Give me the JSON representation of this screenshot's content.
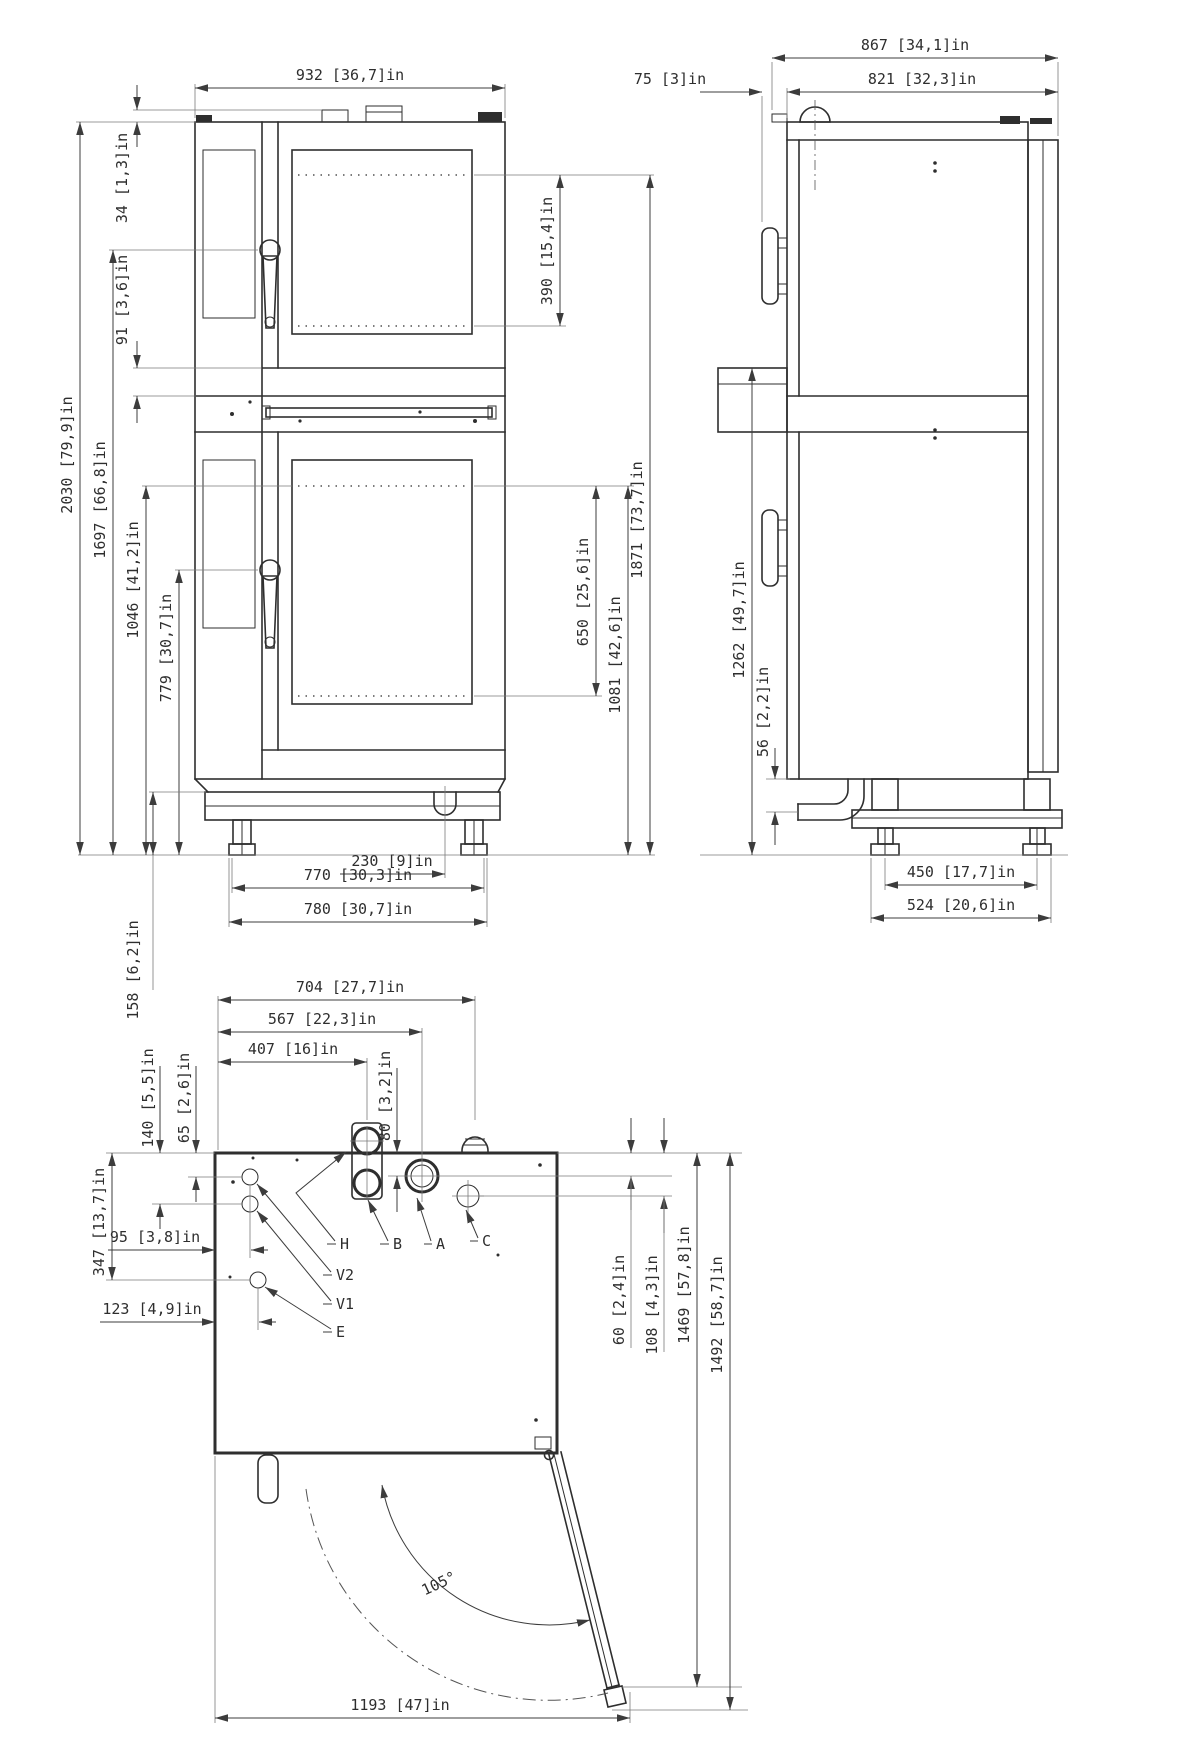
{
  "views": {
    "front": {
      "title": "front view",
      "dims": {
        "d932": "932 [36,7]in",
        "d34": "34 [1,3]in",
        "d91": "91 [3,6]in",
        "d2030": "2030 [79,9]in",
        "d1697": "1697 [66,8]in",
        "d1046": "1046 [41,2]in",
        "d779": "779 [30,7]in",
        "d158": "158 [6,2]in",
        "d390": "390 [15,4]in",
        "d650": "650 [25,6]in",
        "d1081": "1081 [42,6]in",
        "d1871": "1871 [73,7]in",
        "d230": "230 [9]in",
        "d770": "770 [30,3]in",
        "d780": "780 [30,7]in"
      }
    },
    "side": {
      "title": "side view",
      "dims": {
        "d867": "867 [34,1]in",
        "d821": "821 [32,3]in",
        "d75": "75 [3]in",
        "d1262": "1262 [49,7]in",
        "d56": "56 [2,2]in",
        "d450": "450 [17,7]in",
        "d524": "524 [20,6]in"
      }
    },
    "top": {
      "title": "top view",
      "dims": {
        "d704": "704 [27,7]in",
        "d567": "567 [22,3]in",
        "d407": "407 [16]in",
        "d80": "80 [3,2]in",
        "d140": "140 [5,5]in",
        "d65": "65 [2,6]in",
        "d347": "347 [13,7]in",
        "d95": "95 [3,8]in",
        "d123": "123 [4,9]in",
        "d60": "60 [2,4]in",
        "d108": "108 [4,3]in",
        "d1469": "1469 [57,8]in",
        "d1492": "1492 [58,7]in",
        "d1193": "1193 [47]in",
        "door_angle": "105°"
      },
      "connections": {
        "H": "H",
        "B": "B",
        "A": "A",
        "C": "C",
        "V2": "V2",
        "V1": "V1",
        "E": "E"
      }
    }
  }
}
